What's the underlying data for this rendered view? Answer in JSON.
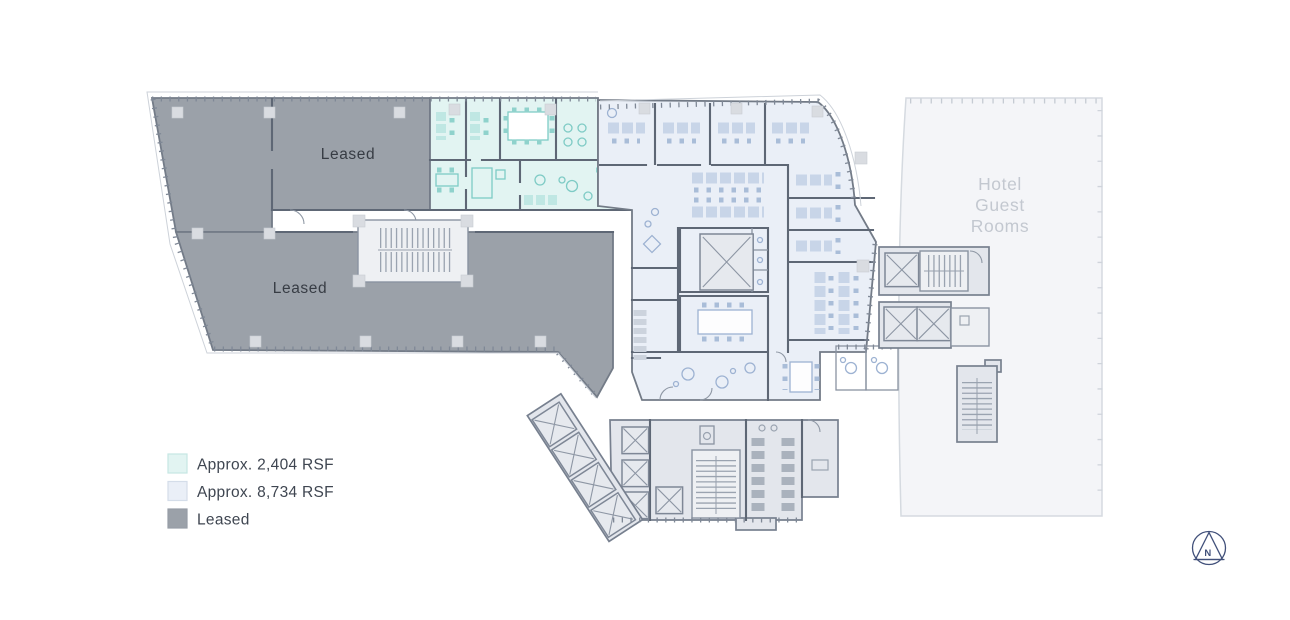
{
  "plan": {
    "labels": {
      "leased_upper": "Leased",
      "leased_lower": "Leased",
      "hotel": [
        "Hotel",
        "Guest",
        "Rooms"
      ]
    }
  },
  "legend": {
    "items": [
      {
        "label": "Approx. 2,404 RSF",
        "color": "#e2f4f2"
      },
      {
        "label": "Approx. 8,734 RSF",
        "color": "#eaeff7"
      },
      {
        "label": "Leased",
        "color": "#9ba1a9"
      }
    ]
  },
  "compass": {
    "label": "N"
  },
  "colors": {
    "leased": "#9ba1a9",
    "suite_2404": "#e2f4f2",
    "suite_8734": "#eaeff7",
    "hotel": "#f4f5f8",
    "core": "#e3e6ec",
    "walls": "#5e6775",
    "teal_furniture": "#7ecbc5",
    "blue_furniture": "#9db2d2",
    "hotel_text": "#c3c8d0",
    "label_text": "#373c44",
    "compass_color": "#41507a"
  }
}
